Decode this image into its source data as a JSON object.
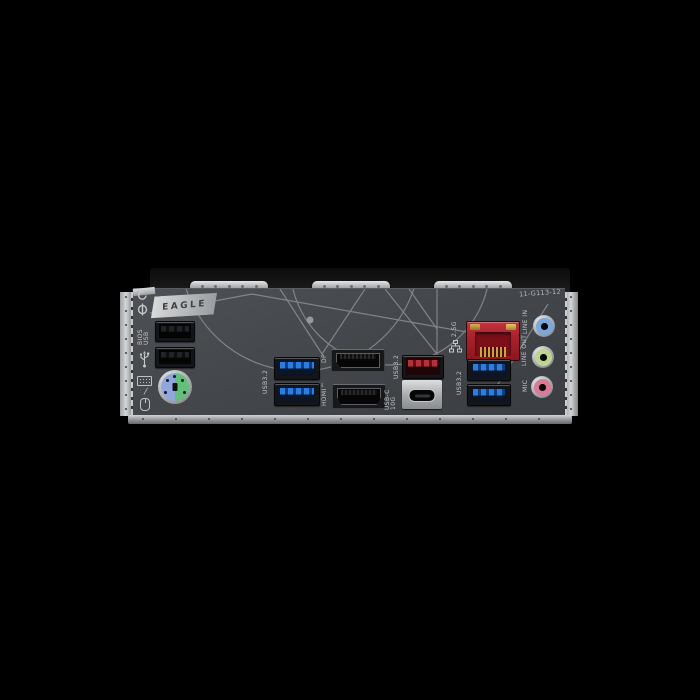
{
  "board": {
    "model_code": "11-G113-12",
    "badge": "EAGLE",
    "heatsink_clip_count": 3,
    "colors": {
      "background": "#000000",
      "panel": "#44474b",
      "line_art": "#8f9396",
      "metal": "#c0c3c5",
      "usb3_blue": "#2b7de0",
      "usb3_red": "#b5303a",
      "lan_red": "#a8222b",
      "ps2_mouse_blue": "#8fa7dd",
      "ps2_keyboard_green": "#63c07a",
      "audio_line_in": "#7aa7dc",
      "audio_line_out": "#bcd68f",
      "audio_mic": "#d97b96"
    }
  },
  "labels": {
    "bios_usb_line1": "BIOS",
    "bios_usb_line2": "USB",
    "usb32_left": "USB3.2",
    "dp": "DP",
    "hdmi": "HDMI™",
    "usb32_mid": "USB3.2",
    "usbc_line1": "USB-C",
    "usbc_line2": "10G",
    "lan_speed": "2.5G",
    "usb32_right": "USB3.2",
    "line_in": "LINE IN",
    "line_out": "LINE OUT",
    "mic": "MIC"
  },
  "ports": [
    {
      "type": "USB 2.0 (BIOS)",
      "count": 1
    },
    {
      "type": "USB 2.0",
      "count": 1
    },
    {
      "type": "PS/2 keyboard-mouse combo",
      "count": 1
    },
    {
      "type": "USB 3.2 blue",
      "count": 4
    },
    {
      "type": "DisplayPort",
      "count": 1
    },
    {
      "type": "HDMI",
      "count": 1
    },
    {
      "type": "USB 3.2 red",
      "count": 1
    },
    {
      "type": "USB-C 10G",
      "count": 1
    },
    {
      "type": "2.5G LAN RJ45",
      "count": 1
    },
    {
      "type": "audio jack",
      "count": 3
    }
  ],
  "icons": [
    "qflash-refresh-icon",
    "qflash-button-icon",
    "usb-icon",
    "keyboard-icon",
    "mouse-icon",
    "lan-network-icon"
  ]
}
